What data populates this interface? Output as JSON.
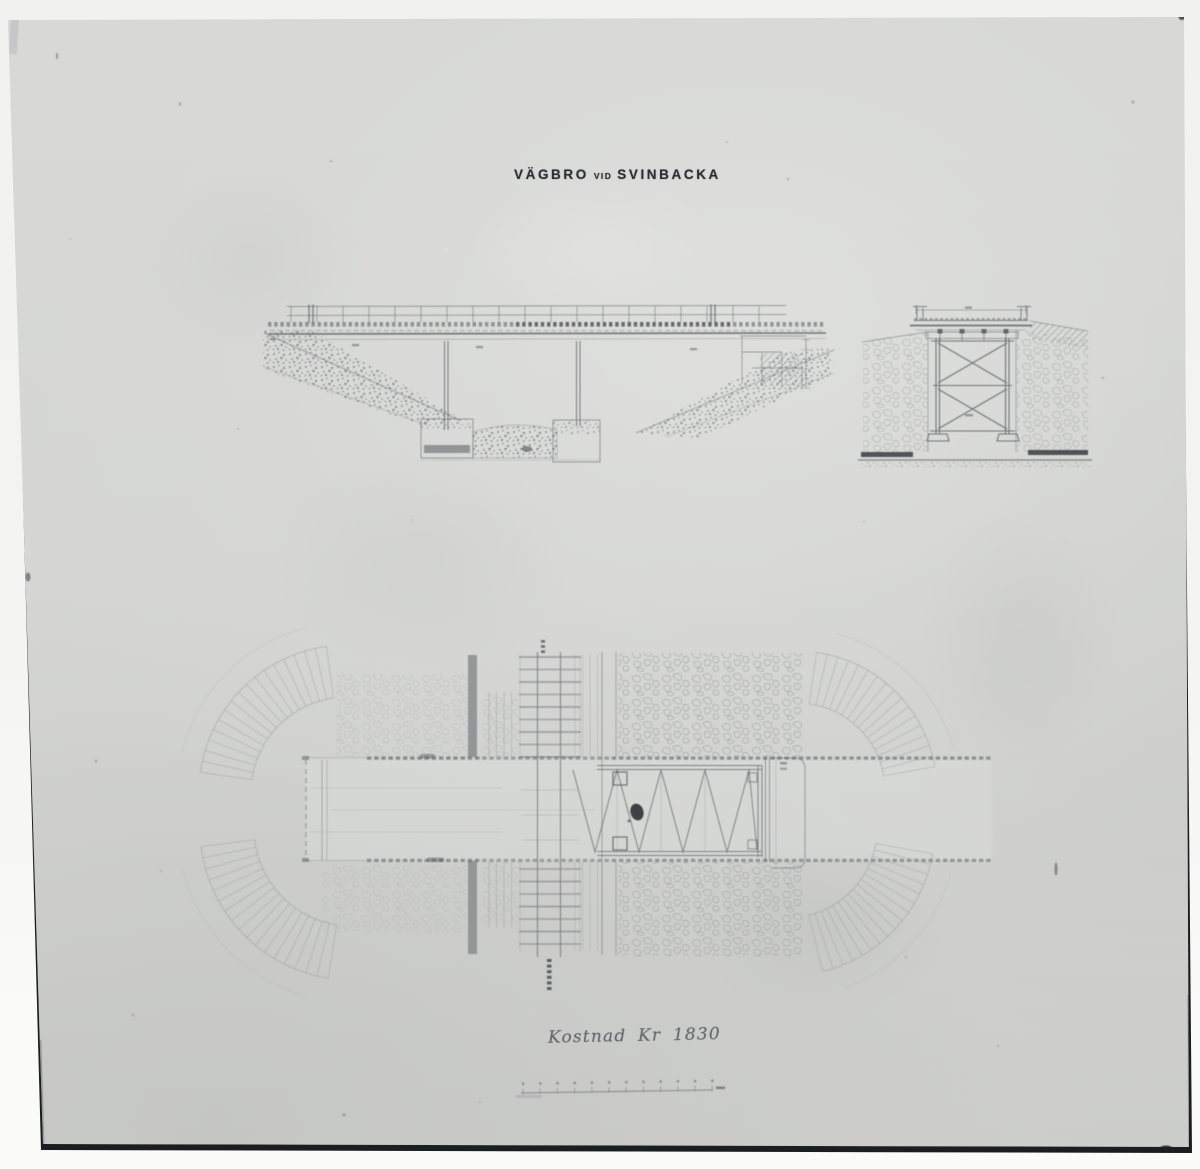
{
  "title": {
    "word1": "VÄGBRO",
    "word2": "VID",
    "word3": "SVINBACKA",
    "full": "VÄGBRO VID SVINBACKA"
  },
  "inscription": {
    "text": "Kostnad Kr 1830"
  },
  "scale_bar": {
    "ticks": 12
  },
  "colors": {
    "photo_paper": "#d5d6d4",
    "margin_white": "#f3f3f1",
    "ink_dark": "#2a2f33",
    "ink_line": "#5d6266",
    "border_black": "#1b1e21"
  }
}
